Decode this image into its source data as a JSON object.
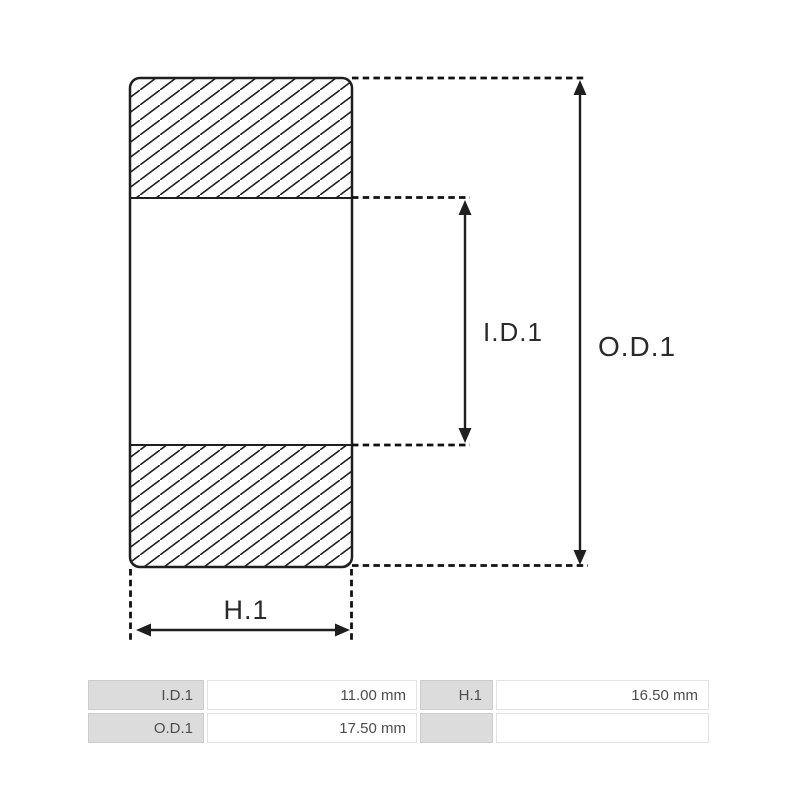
{
  "colors": {
    "line": "#1f1f1f",
    "background": "#ffffff",
    "diagram_label_text": "#2a2a2a",
    "table_label_bg": "#dcdcdc",
    "table_label_border": "#cdcdcd",
    "table_value_border": "#e2e2e2",
    "table_text": "#4d4d4d"
  },
  "diagram": {
    "type": "bearing-cross-section",
    "labels": {
      "inner_diameter": "I.D.1",
      "outer_diameter": "O.D.1",
      "height": "H.1"
    }
  },
  "table": {
    "rows": [
      {
        "cells": [
          {
            "label": "I.D.1",
            "value": "11.00 mm"
          },
          {
            "label": "H.1",
            "value": "16.50 mm"
          }
        ]
      },
      {
        "cells": [
          {
            "label": "O.D.1",
            "value": "17.50 mm"
          },
          {
            "label": "",
            "value": ""
          }
        ]
      }
    ]
  }
}
